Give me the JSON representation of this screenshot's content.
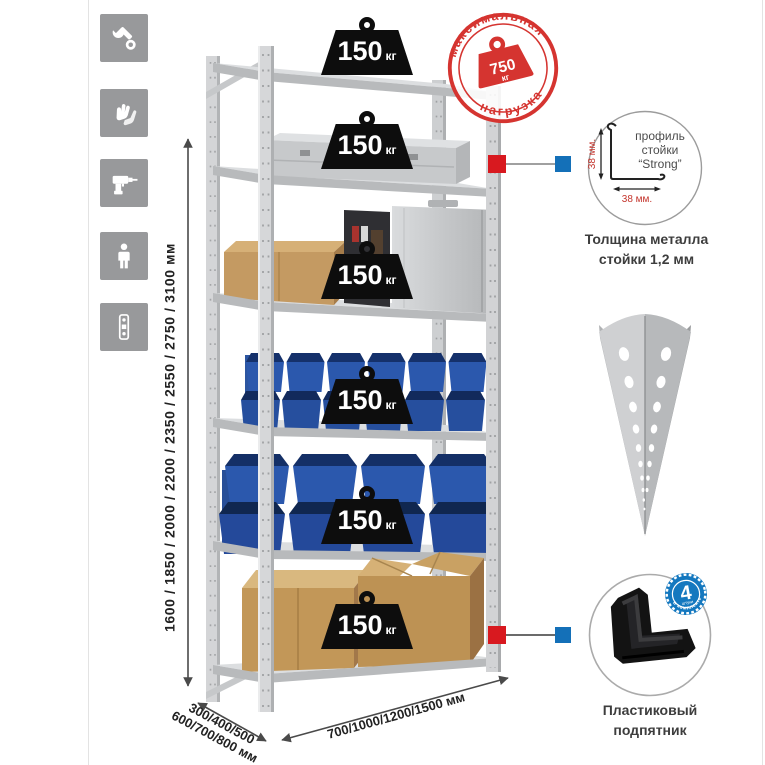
{
  "sidebar_icons": {
    "items": [
      {
        "icon": "wrench-icon"
      },
      {
        "icon": "gloves-icon"
      },
      {
        "icon": "drill-icon"
      },
      {
        "icon": "person-icon"
      },
      {
        "icon": "rack-profile-icon"
      }
    ]
  },
  "dimensions": {
    "height_label": "1600 / 1850 / 2000 / 2200 / 2350 / 2550 / 2750 / 3100 мм",
    "depth_line1": "300/400/500",
    "depth_line2": "600/700/800 мм",
    "width_label": "700/1000/1200/1500 мм"
  },
  "rack": {
    "shelves": [
      {
        "load": "150",
        "unit": "кг"
      },
      {
        "load": "150",
        "unit": "кг"
      },
      {
        "load": "150",
        "unit": "кг"
      },
      {
        "load": "150",
        "unit": "кг"
      },
      {
        "load": "150",
        "unit": "кг"
      },
      {
        "load": "150",
        "unit": "кг"
      }
    ]
  },
  "max_load_stamp": {
    "arc_top": "максимальная",
    "arc_bottom": "нагрузка",
    "value": "750",
    "unit": "кг"
  },
  "profile_detail": {
    "label_line1": "профиль",
    "label_line2": "стойки",
    "label_line3": "“Strong”",
    "dim_vertical": "38 мм.",
    "dim_horizontal": "38 мм.",
    "caption_line1": "Толщина металла",
    "caption_line2": "стойки 1,2 мм"
  },
  "foot_detail": {
    "badge_value": "4",
    "badge_small_text": "штуки",
    "badge_arc_text": "в комплекте",
    "caption_line1": "Пластиковый",
    "caption_line2": "подпятник"
  },
  "colors": {
    "accent_red": "#d53430",
    "accent_blue": "#1470b8",
    "bin_blue": "#2b58ad",
    "metal_gray": "#d4d5d7",
    "icon_tile_gray": "#98999b"
  }
}
